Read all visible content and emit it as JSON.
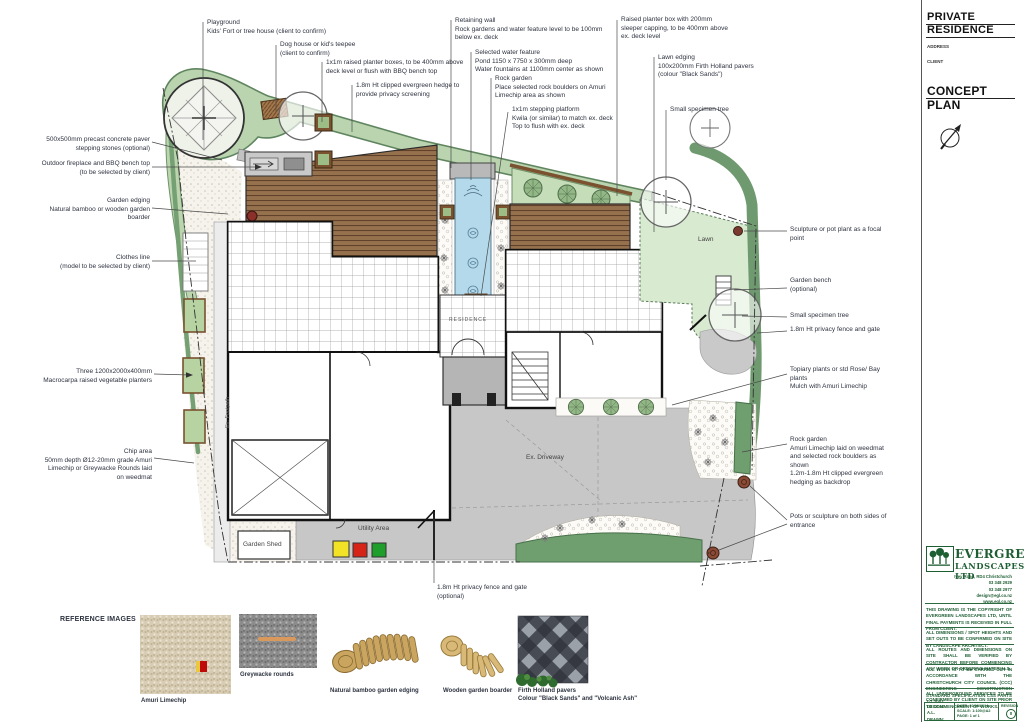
{
  "title_block": {
    "project_line1": "PRIVATE",
    "project_line2": "RESIDENCE",
    "address_label": "ADDRESS",
    "client_label": "CLIENT",
    "plan_type": "CONCEPT PLAN",
    "company_name_1": "EVERGREEN",
    "company_name_2": "LANDSCAPES LTD",
    "contact_block": "Ivey Road, RD4 Christchurch\n03 348 2929\n03 348 2977\ndesign@egl.co.nz\nwww.egl.co.nz",
    "disclaimer_1": "THIS DRAWING IS THE COPYRIGHT OF EVERGREEN LANDSCAPES LTD, UNTIL FINAL PAYMENTS IS RECEIVED IN FULL FROM CLIENT.",
    "disclaimer_2": "ALL DIMENSIONS / SPOT HEIGHTS AND SET OUTS TO BE CONFIRMED ON SITE BY LANDSCAPE ARCHITECT.",
    "disclaimer_3": "ALL ROUTES AND DIMENSIONS ON SITE SHALL BE VERIFIED BY CONTRACTOR BEFORE COMMENCING ANY WORK OR ORDERING MATERIALS.",
    "disclaimer_4": "ALL WORK IS TO BE CARRIED OUT IN ACCORDANCE WITH THE CHRISTCHURCH CITY COUNCIL (CCC) ENGINEERING CONSTRUCTION STANDARD SPECIFICATION CSS PARTS 1-7:2002.",
    "disclaimer_5": "ALL UNDERGROUND SERVICES TO BE CONFIRMED BY CLIENT ON SITE PRIOR TO COMMENCEMENT OF WORKS.",
    "design_drawn": "DESIGN: A.L.\nDRAWN: A.L.",
    "date_scale_page": "DATE: 22/06/2014\nSCALE: 1:100@A2\nPAGE: 1 of 1",
    "revision_label": "REVISION",
    "revision_value": "0"
  },
  "plan_labels": {
    "residence": "RESIDENCE",
    "lawn": "Lawn",
    "driveway": "Ex. Driveway",
    "utility": "Utility Area",
    "shed": "Garden Shed",
    "footpath": "Ex. Footpath"
  },
  "annotations": [
    {
      "name": "playground",
      "text": "Playground\nKids' Fort or tree house (client to confirm)"
    },
    {
      "name": "dog-house",
      "text": "Dog house or kid's teepee\n(client to confirm)"
    },
    {
      "name": "raised-planter-boxes",
      "text": "1x1m raised planter boxes, to be 400mm above\ndeck level or flush with BBQ bench top"
    },
    {
      "name": "privacy-hedge",
      "text": "1.8m Ht clipped evergreen hedge to\nprovide privacy screening"
    },
    {
      "name": "retaining-wall",
      "text": "Retaining wall\nRock gardens and water feature level to be 100mm\nbelow ex. deck"
    },
    {
      "name": "water-feature",
      "text": "Selected water feature\nPond 1150 x 7750 x 300mm deep\nWater fountains at 1100mm center as shown"
    },
    {
      "name": "rock-garden-top",
      "text": "Rock garden\nPlace selected rock boulders on Amuri\nLimechip area as shown"
    },
    {
      "name": "stepping-platform",
      "text": "1x1m stepping platform\nKwila (or similar) to match ex. deck\nTop to flush with ex. deck"
    },
    {
      "name": "raised-planter-box-sleeper",
      "text": "Raised planter box with 200mm\nsleeper capping, to be 400mm above\nex. deck level"
    },
    {
      "name": "lawn-edging",
      "text": "Lawn edging\n100x200mm Firth Holland pavers\n(colour \"Black Sands\")"
    },
    {
      "name": "small-specimen-tree-top",
      "text": "Small specimen tree"
    },
    {
      "name": "stepping-stones",
      "text": "500x500mm precast concrete paver\nstepping stones (optional)"
    },
    {
      "name": "bbq-bench",
      "text": "Outdoor fireplace and BBQ bench top\n(to be selected by client)"
    },
    {
      "name": "garden-edging",
      "text": "Garden edging\nNatural bamboo or wooden garden\nboarder"
    },
    {
      "name": "clothes-line",
      "text": "Clothes line\n(model to be selected by client)"
    },
    {
      "name": "vege-planters",
      "text": "Three 1200x2000x400mm\nMacrocarpa raised vegetable planters"
    },
    {
      "name": "chip-area",
      "text": "Chip area\n50mm depth Ø12-20mm grade Amuri\nLimechip or Greywacke Rounds laid\non weedmat"
    },
    {
      "name": "sculpture-focal",
      "text": "Sculpture or pot plant as a focal\npoint"
    },
    {
      "name": "garden-bench",
      "text": "Garden bench\n(optional)"
    },
    {
      "name": "small-specimen-tree-right",
      "text": "Small specimen tree"
    },
    {
      "name": "privacy-fence-right",
      "text": "1.8m Ht privacy fence and gate"
    },
    {
      "name": "topiary-plants",
      "text": "Topiary plants or std Rose/ Bay\nplants\nMulch with Amuri Limechip"
    },
    {
      "name": "rock-garden-right",
      "text": "Rock garden\nAmuri Limechip laid on weedmat\nand selected rock boulders as\nshown\n1.2m-1.8m Ht clipped evergreen\nhedging as backdrop"
    },
    {
      "name": "entrance-pots",
      "text": "Pots or sculpture on both sides of\nentrance"
    },
    {
      "name": "privacy-fence-bottom",
      "text": "1.8m Ht privacy fence and gate\n(optional)"
    }
  ],
  "reference": {
    "heading": "REFERENCE IMAGES",
    "items": [
      {
        "caption": "Amuri Limechip"
      },
      {
        "caption": "Greywacke rounds"
      },
      {
        "caption": "Natural bamboo garden edging"
      },
      {
        "caption": "Wooden garden boarder"
      },
      {
        "caption": "Firth Holland pavers\nColour \"Black Sands\" and \"Volcanic Ash\""
      }
    ]
  }
}
